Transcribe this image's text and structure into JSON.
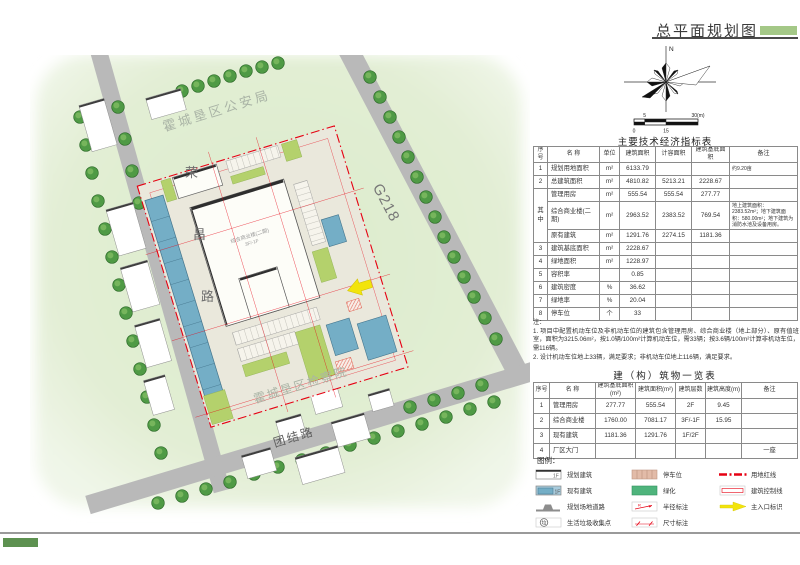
{
  "page": {
    "title": "总平面规划图"
  },
  "compass": {
    "north_label": "N"
  },
  "scale_bar": {
    "labels": [
      "0",
      "5",
      "15",
      "30(m)"
    ]
  },
  "map": {
    "labels": {
      "police": "霍城垦区公安局",
      "procuratorate": "霍城垦区检察院",
      "road_left_chars": [
        "荣",
        "昌",
        "路"
      ],
      "road_right": "G218",
      "road_bottom": "团结路",
      "main_building": "综合商业楼(二期)",
      "main_building_floors": "3F/-1F"
    }
  },
  "indicator_table": {
    "title": "主要技术经济指标表",
    "headers": [
      "序号",
      "名 称",
      "单位",
      "建筑面积",
      "计容面积",
      "建筑基底面积",
      "备注"
    ],
    "group_label": "其 中",
    "rows": [
      {
        "no": "1",
        "name": "规划用地面积",
        "unit": "m²",
        "area": "6133.79",
        "cap": "",
        "base": "",
        "note": "约9.20亩"
      },
      {
        "no": "2",
        "name": "总建筑面积",
        "unit": "m²",
        "area": "4810.82",
        "cap": "5213.21",
        "base": "2228.67",
        "note": ""
      },
      {
        "name": "管理用房",
        "unit": "m²",
        "area": "555.54",
        "cap": "555.54",
        "base": "277.77",
        "note": ""
      },
      {
        "name": "综合商业楼(二期)",
        "unit": "m²",
        "area": "2963.52",
        "cap": "2383.52",
        "base": "769.54",
        "note": "地上建筑面积：2383.52m²；地下建筑面积：580.00m²；地下建筑为消防水池及设备用房。"
      },
      {
        "name": "原有建筑",
        "unit": "m²",
        "area": "1291.76",
        "cap": "2274.15",
        "base": "1181.36",
        "note": ""
      },
      {
        "no": "3",
        "name": "建筑基底面积",
        "unit": "m²",
        "area": "2228.67",
        "cap": "",
        "base": "",
        "note": ""
      },
      {
        "no": "4",
        "name": "绿地面积",
        "unit": "m²",
        "area": "1228.97",
        "cap": "",
        "base": "",
        "note": ""
      },
      {
        "no": "5",
        "name": "容积率",
        "unit": "",
        "area": "0.85",
        "cap": "",
        "base": "",
        "note": ""
      },
      {
        "no": "6",
        "name": "建筑密度",
        "unit": "%",
        "area": "36.62",
        "cap": "",
        "base": "",
        "note": ""
      },
      {
        "no": "7",
        "name": "绿地率",
        "unit": "%",
        "area": "20.04",
        "cap": "",
        "base": "",
        "note": ""
      },
      {
        "no": "8",
        "name": "停车位",
        "unit": "个",
        "area": "33",
        "cap": "",
        "base": "",
        "note": ""
      }
    ]
  },
  "notes": {
    "label": "注：",
    "items": [
      "1. 项目中配置机动车位及非机动车位的建筑包含管理用房、综合商业楼（地上部分）、原有值班室，面积为3215.06m²，按1.0辆/100m²计算机动车位，需33辆；按3.6辆/100m²计算非机动车位，需116辆。",
      "2. 设计机动车位地上33辆，满足要求；非机动车位地上116辆，满足要求。"
    ]
  },
  "buildings_table": {
    "title": "建（构）筑物一览表",
    "headers": [
      "序号",
      "名 称",
      "建筑基底面积(m²)",
      "建筑面积(m²)",
      "建筑层数",
      "建筑高度(m)",
      "备注"
    ],
    "rows": [
      {
        "no": "1",
        "name": "管理用房",
        "base": "277.77",
        "area": "555.54",
        "floors": "2F",
        "height": "9.45",
        "note": ""
      },
      {
        "no": "2",
        "name": "综合商业楼",
        "base": "1760.00",
        "area": "7081.17",
        "floors": "3F/-1F",
        "height": "15.95",
        "note": ""
      },
      {
        "no": "3",
        "name": "现有建筑",
        "base": "1181.36",
        "area": "1291.76",
        "floors": "1F/2F",
        "height": "",
        "note": ""
      },
      {
        "no": "4",
        "name": "厂区大门",
        "base": "",
        "area": "",
        "floors": "",
        "height": "",
        "note": "一座"
      }
    ]
  },
  "legend": {
    "title": "图例：",
    "floor_label": "1F",
    "radius_char": "R",
    "trash_char": "垃",
    "items": [
      "规划建筑",
      "停车位",
      "用地红线",
      "现有建筑",
      "绿化",
      "建筑控制线",
      "规划场地道路",
      "半径标注",
      "主入口标识",
      "生活垃圾收集点",
      "尺寸标注"
    ]
  },
  "colors": {
    "accent_green": "#a4c887",
    "red_line": "#e60012",
    "legend_green": "#4fb47c",
    "existing_blue": "#74aec6",
    "parking_pink": "#e2bba8",
    "entrance_yellow": "#f2e40c"
  }
}
